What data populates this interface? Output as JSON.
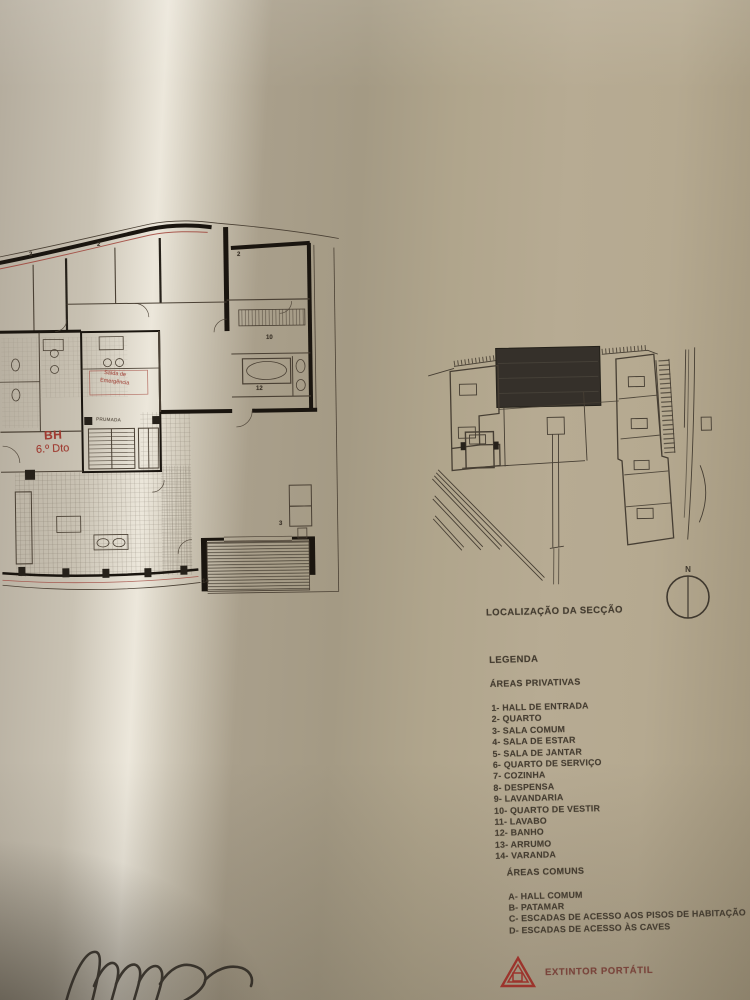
{
  "site_plan": {
    "caption": "LOCALIZAÇÃO DA SECÇÃO",
    "compass_label": "N"
  },
  "legend": {
    "title": "LEGENDA",
    "private_title": "ÁREAS PRIVATIVAS",
    "private_items": [
      "1- HALL DE ENTRADA",
      "2- QUARTO",
      "3- SALA COMUM",
      "4- SALA DE ESTAR",
      "5- SALA DE JANTAR",
      "6- QUARTO DE SERVIÇO",
      "7- COZINHA",
      "8- DESPENSA",
      "9- LAVANDARIA",
      "10- QUARTO DE VESTIR",
      "11- LAVABO",
      "12- BANHO",
      "13- ARRUMO",
      "14- VARANDA"
    ],
    "common_title": "ÁREAS COMUNS",
    "common_items": [
      "A- HALL COMUM",
      "B- PATAMAR",
      "C- ESCADAS DE ACESSO AOS PISOS DE HABITAÇÃO",
      "D- ESCADAS DE ACESSO ÀS CAVES"
    ]
  },
  "safety": {
    "extinguisher_label": "EXTINTOR PORTÁTIL"
  },
  "floor_plan": {
    "unit_line1": "BH",
    "unit_line2": "6.º Dto",
    "exit_line1": "Saída de",
    "exit_line2": "Emergência",
    "shaft_label": "PRUMADA",
    "room_numbers": [
      "2",
      "2",
      "2",
      "10",
      "12",
      "3",
      "14"
    ]
  },
  "colors": {
    "accent_red": "#9c3a31",
    "ink": "#453d31",
    "wall_black": "#1a150f",
    "paper_highlight": "#ece7db",
    "paper_shadow": "#a49a84"
  }
}
